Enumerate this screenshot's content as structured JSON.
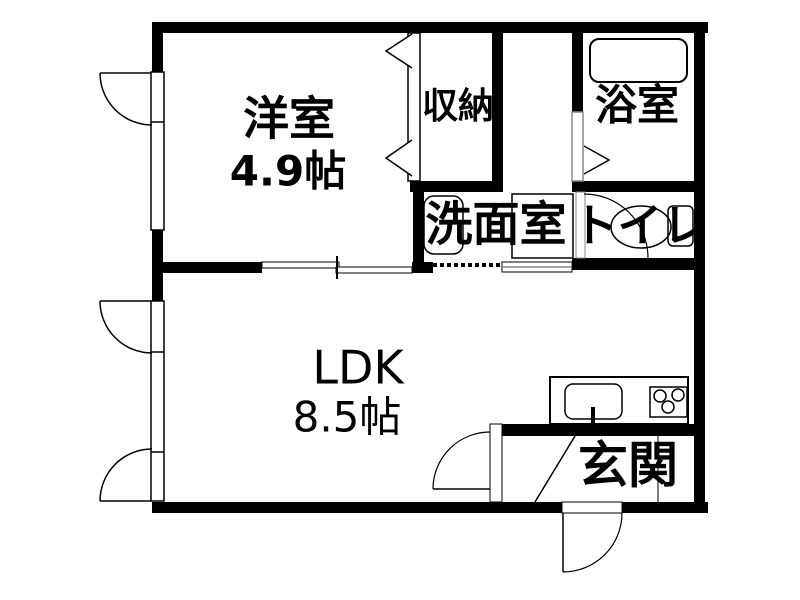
{
  "title": "1LDK apartment floor plan",
  "colors": {
    "wall": "#000000",
    "background": "#ffffff",
    "fixture_line": "#000000",
    "door_panel_line": "#888888"
  },
  "rooms": {
    "western": {
      "label": "洋室",
      "size": "4.9帖"
    },
    "ldk": {
      "label": "LDK",
      "size": "8.5帖"
    },
    "closet": {
      "label": "収納"
    },
    "bath": {
      "label": "浴室"
    },
    "washroom": {
      "label": "洗面室"
    },
    "toilet": {
      "label": "トイレ"
    },
    "entrance": {
      "label": "玄関"
    }
  },
  "fixtures": {
    "bathtub": "bathtub-icon",
    "kitchen_sink": "kitchen-sink-icon",
    "stove": "gas-stove-icon",
    "toilet_bowl": "toilet-bowl-icon",
    "washbasin": "washbasin-icon",
    "washer_pan": "washing-machine-pan-icon"
  }
}
